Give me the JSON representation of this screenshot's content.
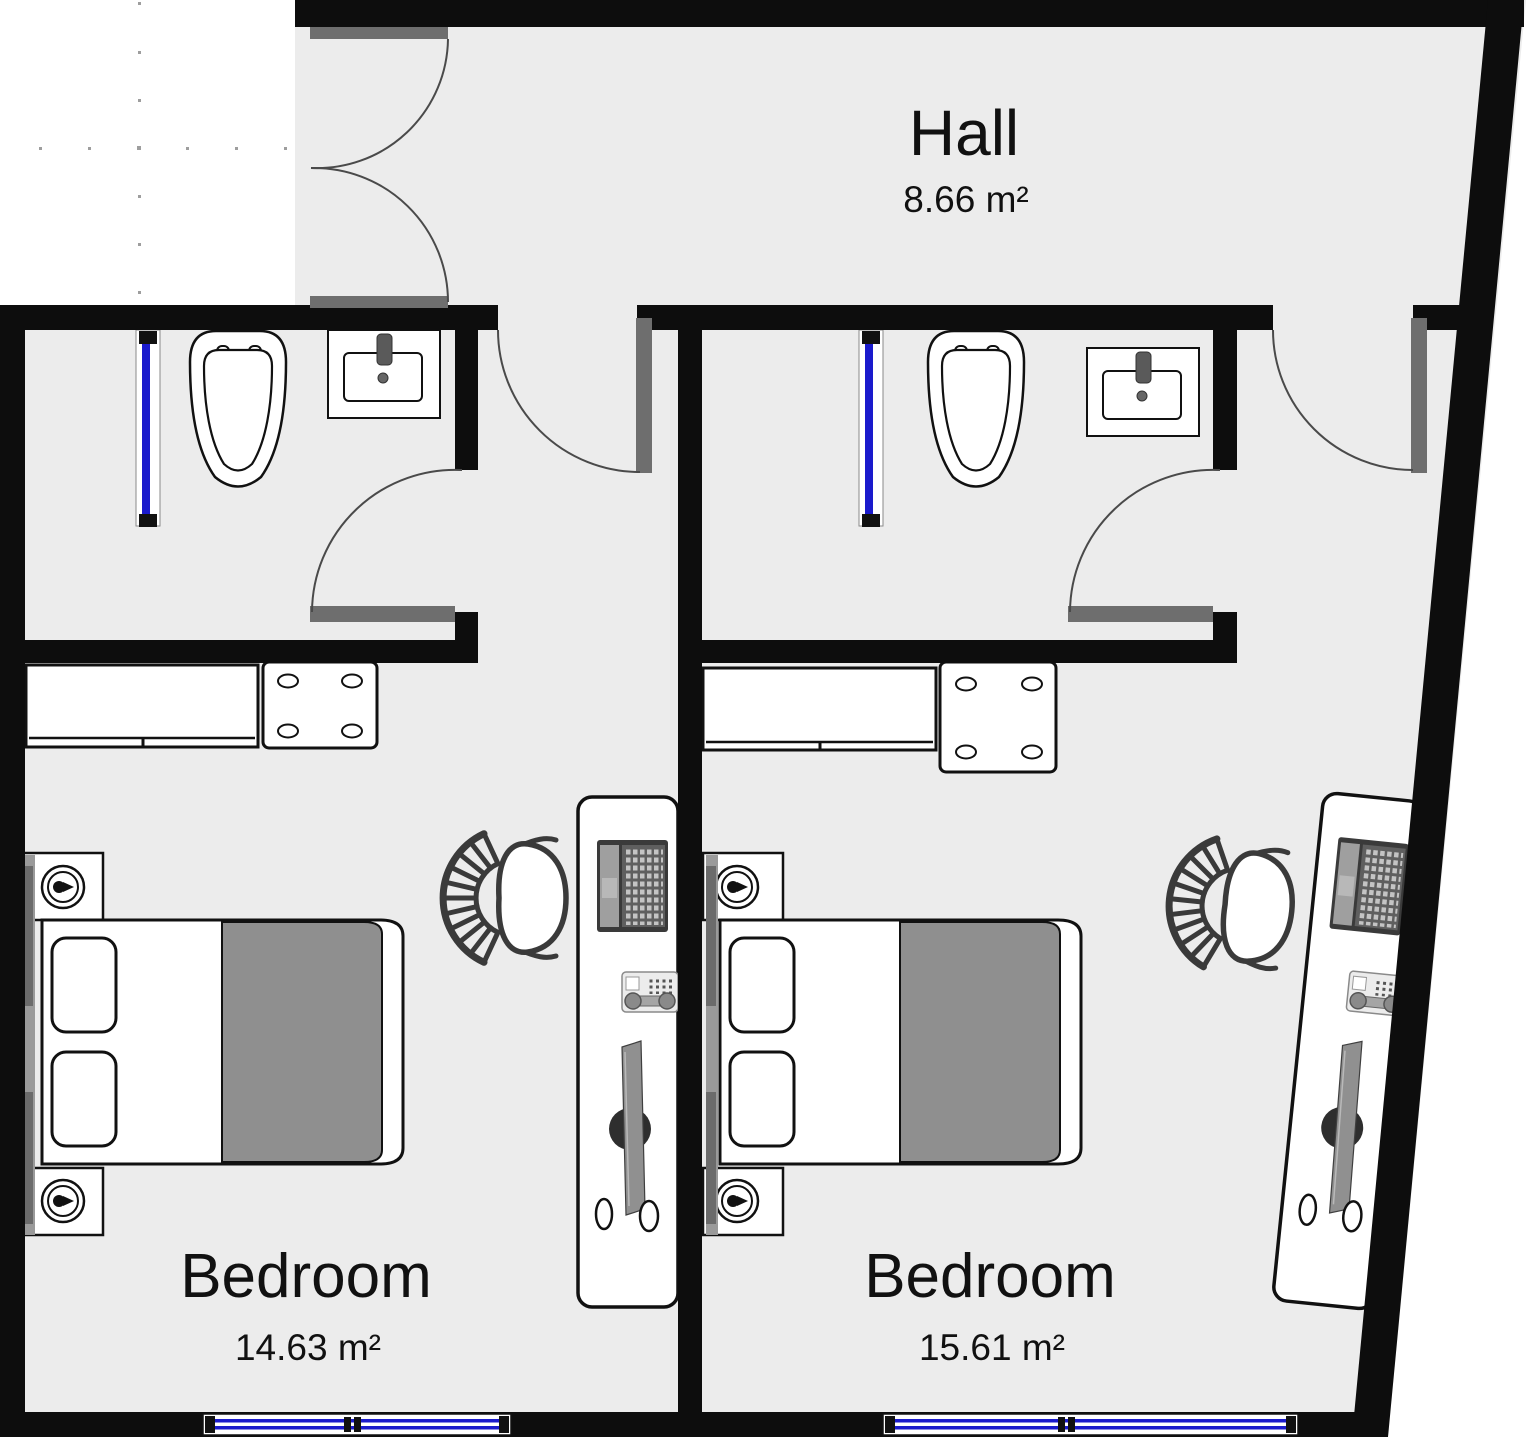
{
  "plan": {
    "rooms": [
      {
        "name": "Hall",
        "area": "8.66 m²"
      },
      {
        "name": "Bedroom",
        "area": "14.63 m²"
      },
      {
        "name": "Bedroom",
        "area": "15.61 m²"
      }
    ]
  },
  "colors": {
    "floor": "#ececec",
    "wall": "#0d0d0d",
    "door_leaf": "#6e6e6e",
    "window_glass": "#1a1acc",
    "blanket": "#8f8f8f",
    "exterior": "#ffffff"
  },
  "icons": {
    "toilet": "toilet-top-view",
    "sink": "sink-vanity-top-view",
    "shower_glass": "shower-glass-panel",
    "bed": "double-bed-top-view",
    "lamp": "nightstand-lamp",
    "desk_chair": "office-chair-top-view",
    "laptop": "laptop-top-view",
    "phone": "desk-phone",
    "monitor": "monitor-side-on-desk"
  }
}
